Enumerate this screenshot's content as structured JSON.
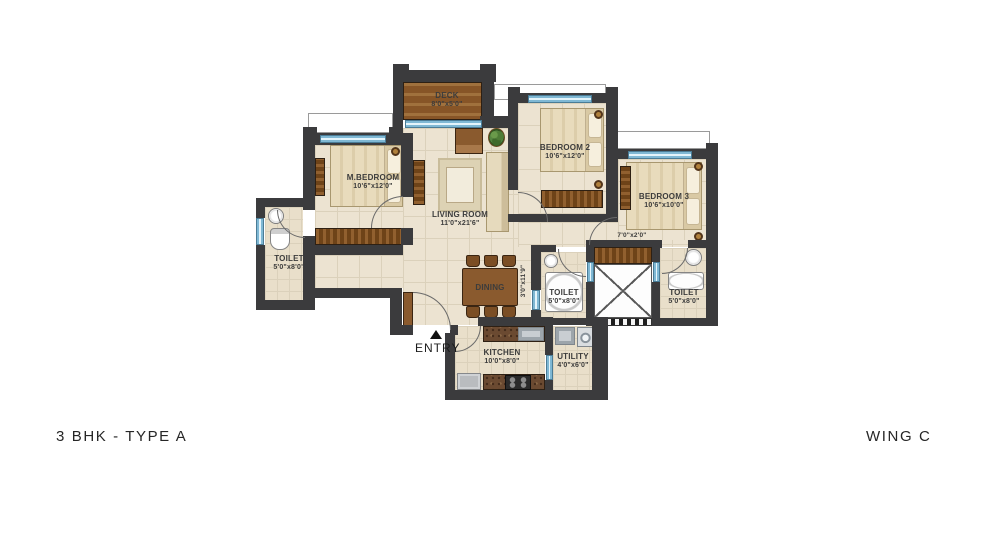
{
  "plan": {
    "titles": {
      "left": "3 BHK - TYPE A",
      "right": "WING C"
    },
    "rooms": {
      "deck": {
        "name": "DECK",
        "dims": "8'0\"x5'0\""
      },
      "m_bedroom": {
        "name": "M.BEDROOM",
        "dims": "10'6\"x12'0\""
      },
      "living": {
        "name": "LIVING ROOM",
        "dims": "11'0\"x21'6\""
      },
      "dining": {
        "name": "DINING"
      },
      "bedroom2": {
        "name": "BEDROOM 2",
        "dims": "10'6\"x12'0\""
      },
      "bedroom3": {
        "name": "BEDROOM 3",
        "dims": "10'6\"x10'0\""
      },
      "toilet_left": {
        "name": "TOILET",
        "dims": "5'0\"x8'0\""
      },
      "toilet_mid": {
        "name": "TOILET",
        "dims": "5'0\"x8'0\""
      },
      "toilet_right": {
        "name": "TOILET",
        "dims": "5'0\"x8'0\""
      },
      "kitchen": {
        "name": "KITCHEN",
        "dims": "10'0\"x8'0\""
      },
      "utility": {
        "name": "UTILITY",
        "dims": "4'0\"x6'0\""
      },
      "passage": {
        "dims": "7'0\"x2'0\""
      },
      "hall_passage": {
        "dims": "3'0\"x11'9\""
      },
      "entry": {
        "label": "ENTRY"
      }
    },
    "colors": {
      "wall": "#3b3b3d",
      "window": "#bfe3f2",
      "wood": "#8a5a2e",
      "floor": "#ece3d1",
      "background": "#ffffff"
    }
  }
}
